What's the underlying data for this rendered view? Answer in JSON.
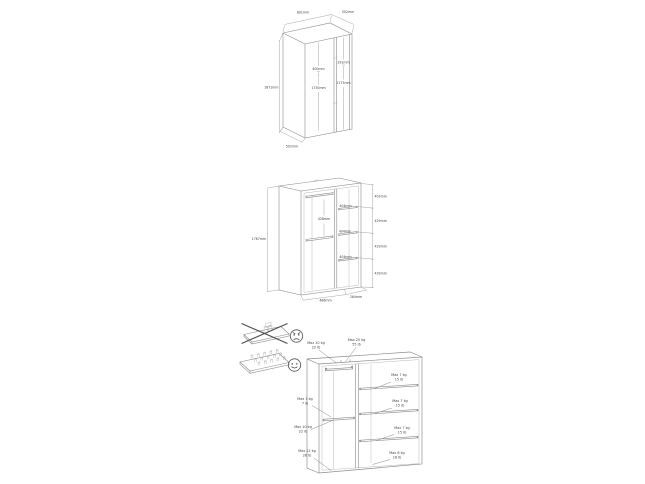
{
  "page": {
    "title": "wardrobe assembly dimension sheet",
    "colors": {
      "background": "#ffffff",
      "line": "#8a8a8a",
      "dim_line": "#9c9c9c",
      "text": "#3f3f3f",
      "warning": "#4f4f4f"
    }
  },
  "views": {
    "exterior": {
      "width": "801mm",
      "depth": "502mm",
      "height": "1871mm",
      "left_door_width": "400mm",
      "left_door_height": "1730mm",
      "right_door_top": "291mm",
      "right_door_height": "1173mm",
      "base_depth": "502mm"
    },
    "interior": {
      "height": "1767mm",
      "section_heights": [
        "403mm",
        "429mm",
        "429mm",
        "439mm"
      ],
      "rail_to_shelf": "428mm",
      "shelf_depths": [
        "404mm",
        "404mm",
        "404mm"
      ],
      "base_width": "486mm",
      "base_depth": "264mm"
    },
    "max_load": {
      "callouts": [
        {
          "kg": "Max 10 kg",
          "lb": "22 lb"
        },
        {
          "kg": "Max 25 kg",
          "lb": "55 lb"
        },
        {
          "kg": "Max 7 kg",
          "lb": "15 lb"
        },
        {
          "kg": "Max 3 kg",
          "lb": "7 lb"
        },
        {
          "kg": "Max 7 kg",
          "lb": "15 lb"
        },
        {
          "kg": "Max 10 kg",
          "lb": "22 lb"
        },
        {
          "kg": "Max 7 kg",
          "lb": "15 lb"
        },
        {
          "kg": "Max 12 kg",
          "lb": "26 lb"
        },
        {
          "kg": "Max 8 kg",
          "lb": "18 lb"
        }
      ],
      "icons": {
        "wrong": "concentrated-load-crossed",
        "correct": "distributed-load",
        "wrong_face": "angry-face",
        "correct_face": "happy-face"
      }
    }
  }
}
